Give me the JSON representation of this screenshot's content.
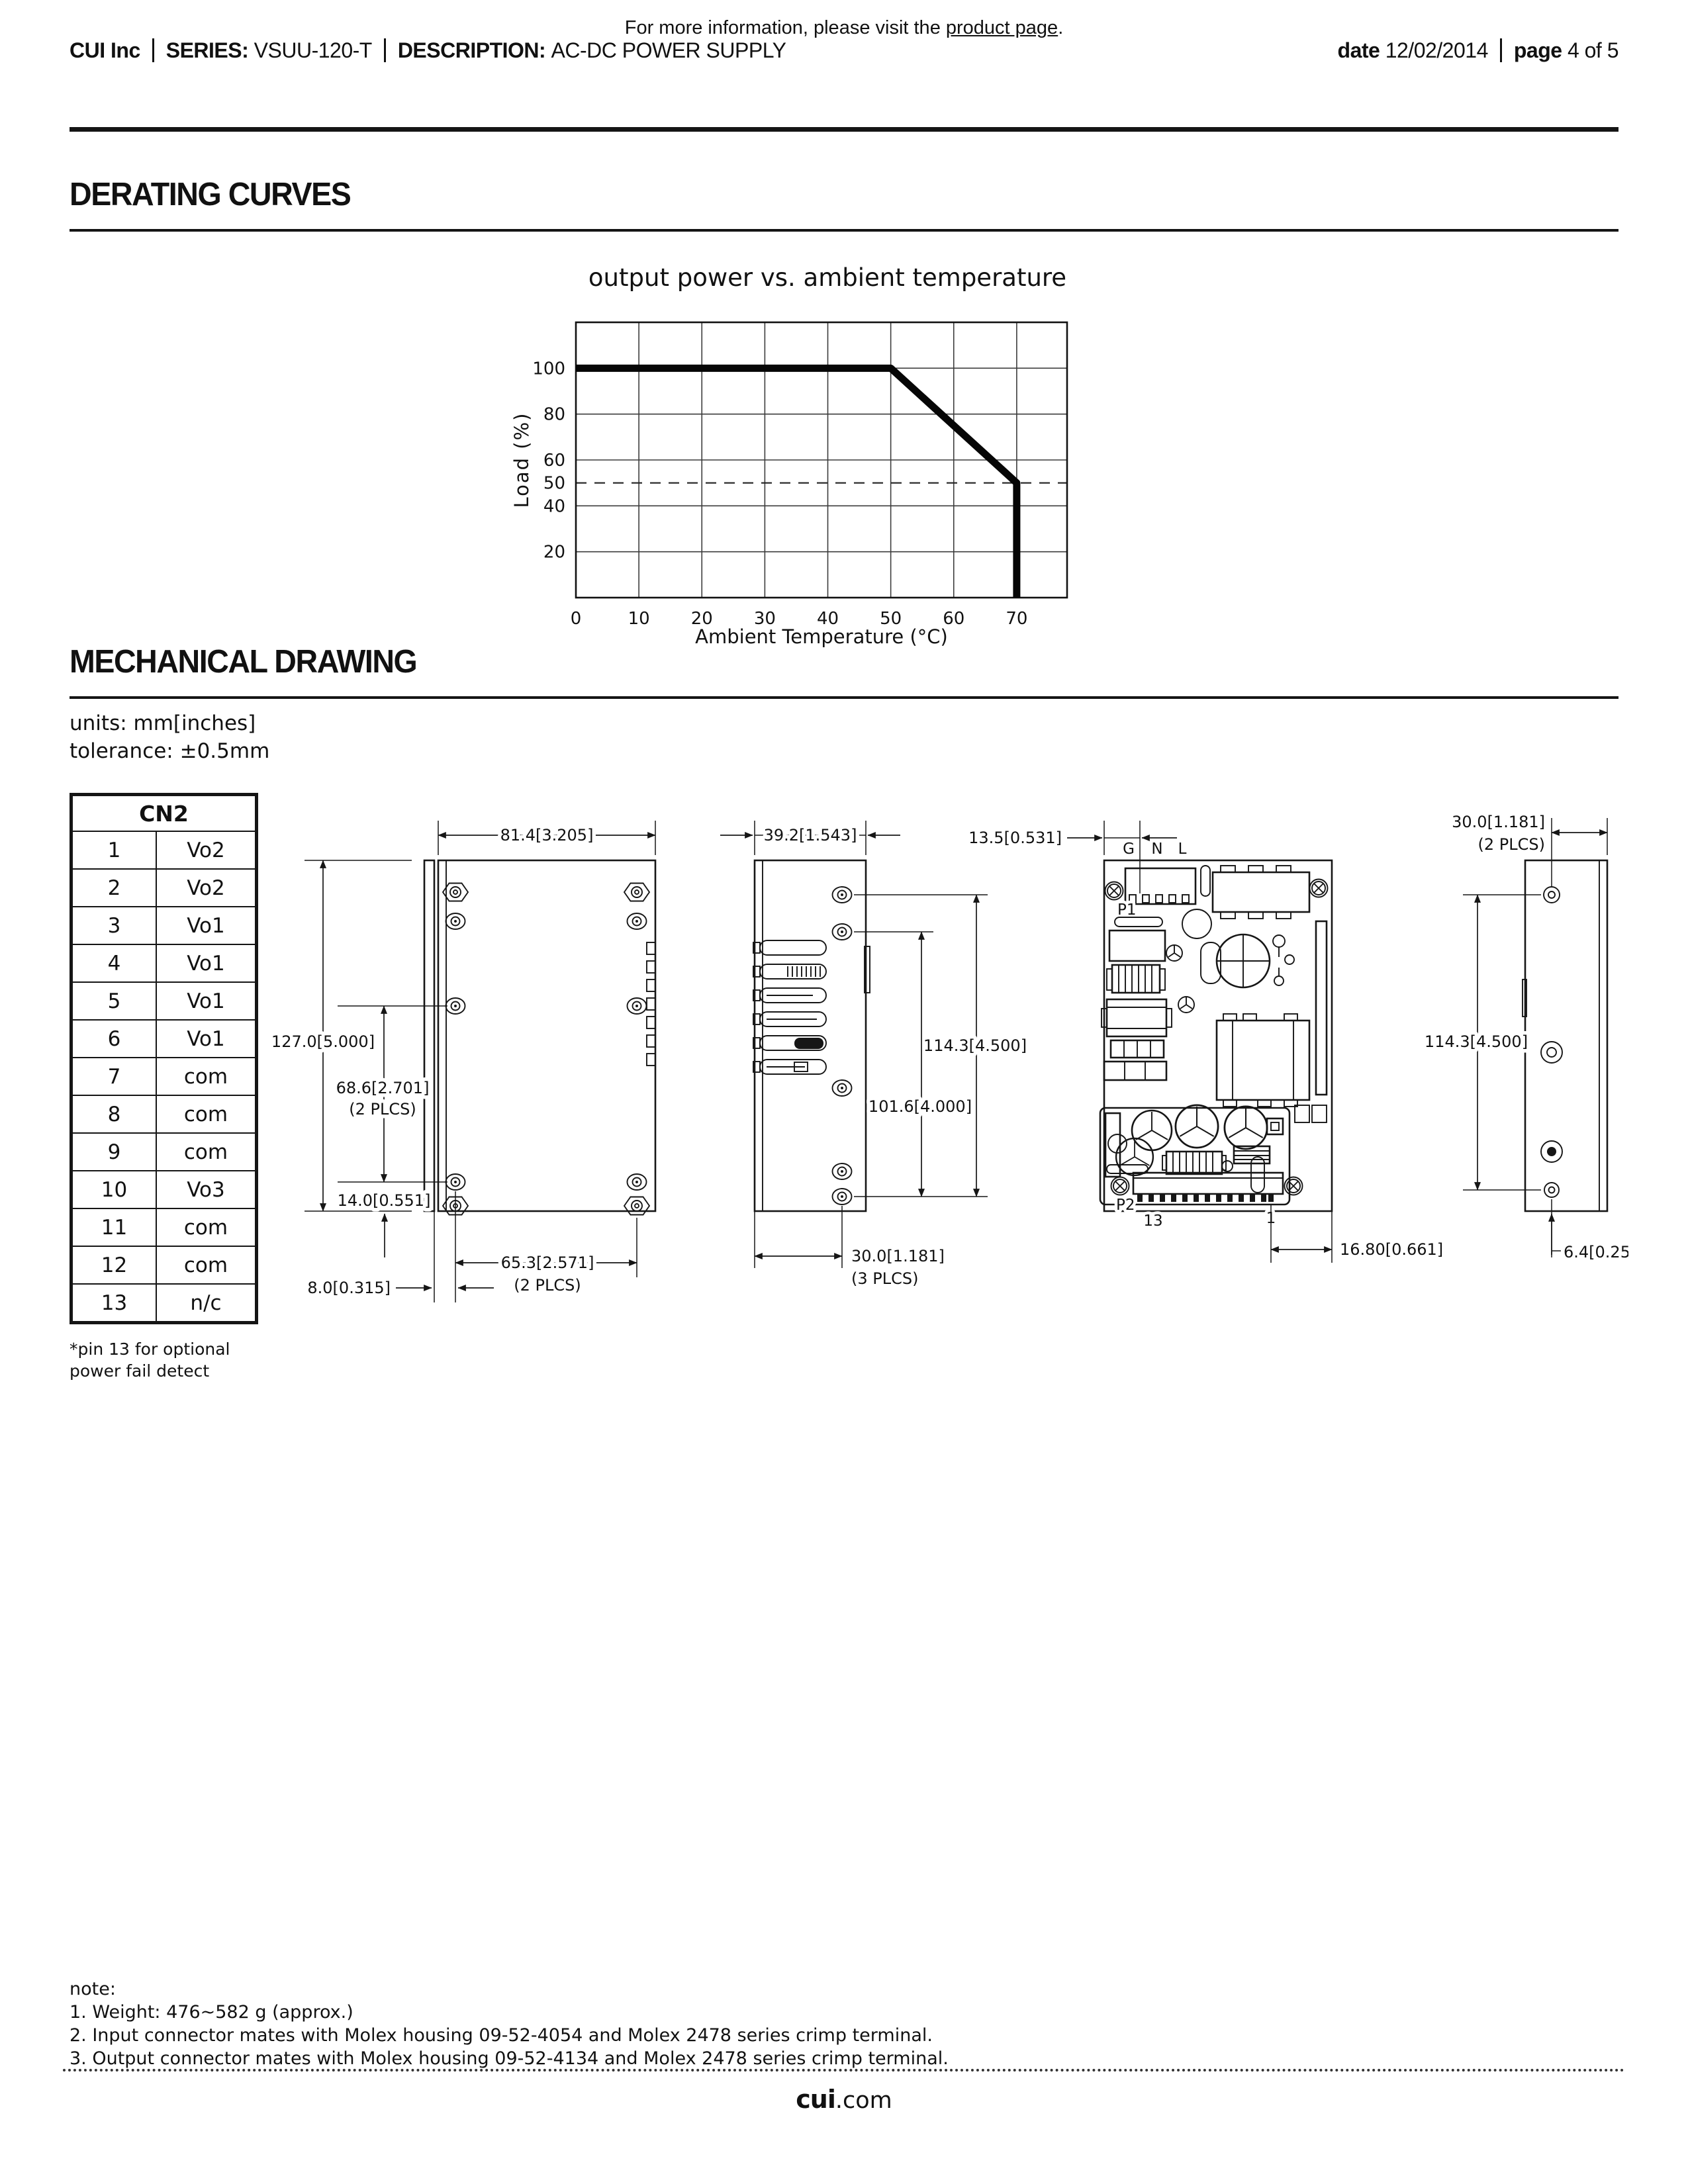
{
  "top_note": {
    "prefix": "For more information, please visit the ",
    "link": "product page",
    "suffix": "."
  },
  "header": {
    "brand": "CUI Inc",
    "series_label": "SERIES:",
    "series_value": "VSUU-120-T",
    "description_label": "DESCRIPTION:",
    "description_value": "AC-DC POWER SUPPLY",
    "date_label": "date",
    "date_value": "12/02/2014",
    "page_label": "page",
    "page_value": "4 of 5"
  },
  "sections": {
    "derating": "DERATING CURVES",
    "mechanical": "MECHANICAL DRAWING"
  },
  "chart_data": {
    "type": "line",
    "title": "output power vs. ambient temperature",
    "xlabel": "Ambient Temperature (°C)",
    "ylabel": "Load (%)",
    "xlim": [
      0,
      78
    ],
    "ylim": [
      0,
      120
    ],
    "xticks": [
      0,
      10,
      20,
      30,
      40,
      50,
      60,
      70
    ],
    "yticks": [
      20,
      40,
      50,
      60,
      80,
      100
    ],
    "grid": true,
    "legend": "none",
    "series": [
      {
        "name": "derating-curve",
        "x": [
          0,
          50,
          70,
          70
        ],
        "y": [
          100,
          100,
          50,
          0
        ]
      }
    ],
    "reference_line": {
      "y": 50,
      "style": "dashed"
    }
  },
  "mechanical": {
    "units_note": "units: mm[inches]",
    "tolerance_note": "tolerance: ±0.5mm",
    "cn2": {
      "title": "CN2",
      "rows": [
        {
          "pin": "1",
          "net": "Vo2"
        },
        {
          "pin": "2",
          "net": "Vo2"
        },
        {
          "pin": "3",
          "net": "Vo1"
        },
        {
          "pin": "4",
          "net": "Vo1"
        },
        {
          "pin": "5",
          "net": "Vo1"
        },
        {
          "pin": "6",
          "net": "Vo1"
        },
        {
          "pin": "7",
          "net": "com"
        },
        {
          "pin": "8",
          "net": "com"
        },
        {
          "pin": "9",
          "net": "com"
        },
        {
          "pin": "10",
          "net": "Vo3"
        },
        {
          "pin": "11",
          "net": "com"
        },
        {
          "pin": "12",
          "net": "com"
        },
        {
          "pin": "13",
          "net": "n/c"
        }
      ],
      "footnote_line1": "*pin 13 for optional",
      "footnote_line2": "power fail detect"
    },
    "dims": {
      "d1_width": "81.4[3.205]",
      "d1_height": "127.0[5.000]",
      "d1_hole_v": "68.6[2.701]",
      "d1_hole_v_note": "(2 PLCS)",
      "d1_hole_bottom": "14.0[0.551]",
      "d1_strip": "8.0[0.315]",
      "d1_hole_h": "65.3[2.571]",
      "d1_hole_h_note": "(2 PLCS)",
      "d2_width": "39.2[1.543]",
      "d2_height": "114.3[4.500]",
      "d2_inner": "101.6[4.000]",
      "d2_bottom": "30.0[1.181]",
      "d2_bottom_note": "(3 PLCS)",
      "d3_offset": "13.5[0.531]",
      "d3_g": "G",
      "d3_n": "N",
      "d3_l": "L",
      "d3_p1": "P1",
      "d3_p2": "P2",
      "d3_pin13": "13",
      "d3_pin1": "1",
      "d3_pin_offset": "16.80[0.661]",
      "d4_width": "30.0[1.181]",
      "d4_width_note": "(2 PLCS)",
      "d4_height": "114.3[4.500]",
      "d4_hole_bottom": "6.4[0.252]"
    }
  },
  "notes": {
    "title": "note:",
    "items": [
      "1. Weight: 476~582 g (approx.)",
      "2. Input connector mates with Molex housing 09-52-4054 and Molex 2478 series crimp terminal.",
      "3. Output connector mates with Molex housing 09-52-4134 and Molex 2478 series crimp terminal."
    ]
  },
  "footer": {
    "brand": "cui",
    "suffix": ".com"
  }
}
